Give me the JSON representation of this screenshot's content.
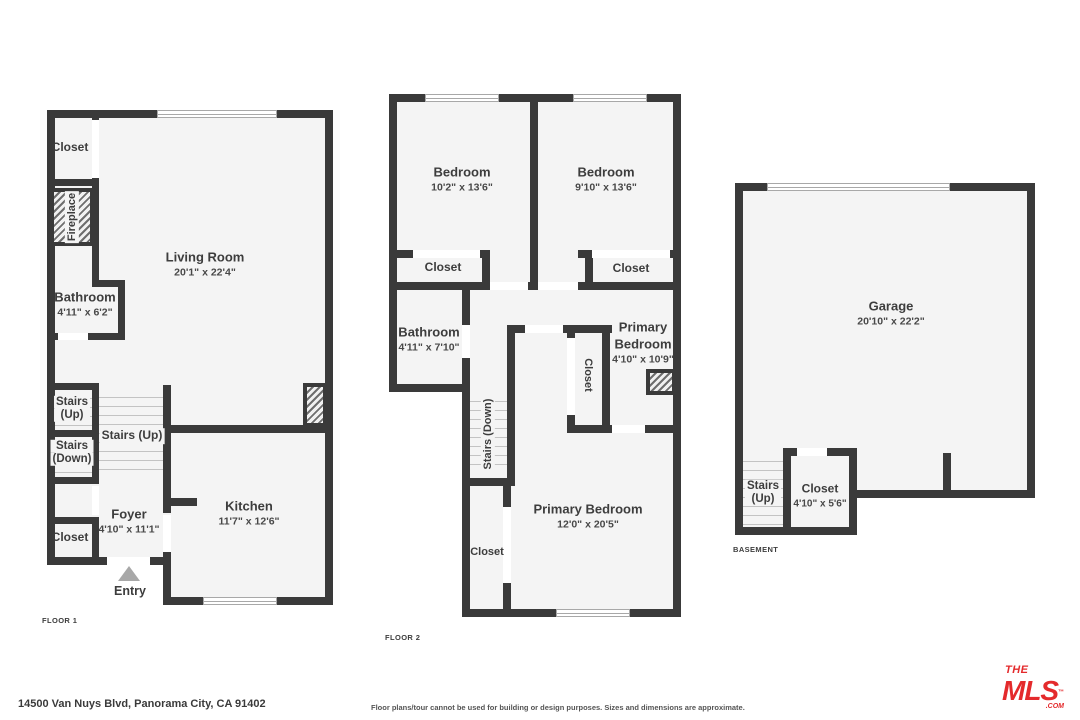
{
  "colors": {
    "wall": "#3a3a3a",
    "floor_fill": "#f4f4f4",
    "logo_red": "#e42a2c"
  },
  "floor1": {
    "tag": "FLOOR 1",
    "rooms": {
      "closet_top": {
        "name": "Closet"
      },
      "fireplace": {
        "name": "Fireplace"
      },
      "living": {
        "name": "Living Room",
        "dims": "20'1\" x 22'4\""
      },
      "bathroom": {
        "name": "Bathroom",
        "dims": "4'11\" x 6'2\""
      },
      "stairs_up_box": {
        "line1": "Stairs",
        "line2": "(Up)"
      },
      "stairs_down_box": {
        "line1": "Stairs",
        "line2": "(Down)"
      },
      "stairs_main": {
        "name": "Stairs (Up)"
      },
      "foyer": {
        "name": "Foyer",
        "dims": "4'10\" x 11'1\""
      },
      "closet_bottom": {
        "name": "Closet"
      },
      "kitchen": {
        "name": "Kitchen",
        "dims": "11'7\" x 12'6\""
      },
      "entry": {
        "name": "Entry"
      }
    }
  },
  "floor2": {
    "tag": "FLOOR 2",
    "rooms": {
      "bedroom_left": {
        "name": "Bedroom",
        "dims": "10'2\" x 13'6\""
      },
      "bedroom_right": {
        "name": "Bedroom",
        "dims": "9'10\" x 13'6\""
      },
      "closet_left": {
        "name": "Closet"
      },
      "closet_right": {
        "name": "Closet"
      },
      "bathroom": {
        "name": "Bathroom",
        "dims": "4'11\" x 7'10\""
      },
      "primary_small": {
        "name": "Primary Bedroom",
        "dims": "4'10\" x 10'9\""
      },
      "closet_mid": {
        "name": "Closet"
      },
      "stairs_down": {
        "name": "Stairs (Down)"
      },
      "primary_large": {
        "name": "Primary Bedroom",
        "dims": "12'0\" x 20'5\""
      },
      "closet_lower": {
        "name": "Closet"
      }
    }
  },
  "basement": {
    "tag": "BASEMENT",
    "rooms": {
      "garage": {
        "name": "Garage",
        "dims": "20'10\" x 22'2\""
      },
      "stairs": {
        "line1": "Stairs",
        "line2": "(Up)"
      },
      "closet": {
        "name": "Closet",
        "dims": "4'10\" x 5'6\""
      }
    }
  },
  "footer": {
    "address": "14500 Van Nuys Blvd, Panorama City, CA 91402",
    "disclaimer": "Floor plans/tour cannot be used for building or design purposes. Sizes and dimensions are approximate."
  },
  "logo": {
    "the": "THE",
    "mls": "MLS",
    "tm": "™",
    "com": ".COM"
  }
}
